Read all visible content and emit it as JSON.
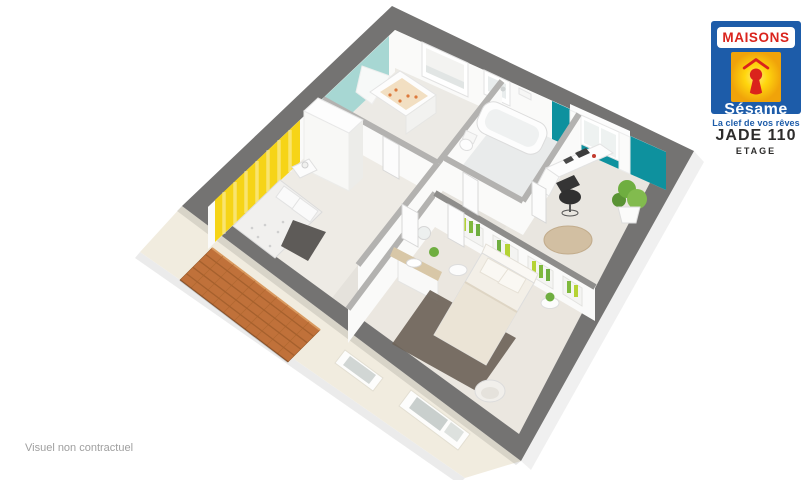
{
  "logo": {
    "brand_top": "MAISONS",
    "brand_script": "Sésame",
    "tagline": "La clef de vos rêves"
  },
  "plan": {
    "title": "JADE 110",
    "subtitle": "ETAGE",
    "disclaimer": "Visuel non contractuel"
  },
  "colors": {
    "logo_blue": "#1d5ca9",
    "logo_red": "#da231c",
    "logo_yellow": "#ffd60e",
    "logo_orange": "#f0a30a",
    "tagline_blue": "#1d5ca9",
    "title_dark": "#2d2c2b",
    "disclaimer_gray": "#9f9f9f",
    "outer_wall": "#747372",
    "wall_top": "#b3b2b0",
    "wall_top_dark": "#8e8d8b",
    "wall_face": "#fafaf9",
    "floor_base": "#e5e2dc",
    "floor_nursery": "#eceae5",
    "floor_bath": "#e9ebeb",
    "floor_office": "#e9e6e0",
    "floor_bed1": "#eeebe5",
    "floor_master": "#ebe7e0",
    "accent_aqua": "#a7d7d3",
    "accent_teal": "#0e919e",
    "accent_yellow": "#f6d417",
    "roof": "#c0713a",
    "roof_line": "#9a5a28",
    "facade": "#f1ecdf",
    "glass": "#c9cfcd",
    "rug_dark": "#6e6459",
    "rug_jute": "#d2bfa2",
    "throw_dark": "#5e5b58",
    "wood": "#d8c7a7",
    "plant": "#6fae40",
    "plant_light": "#b5d334",
    "chair_dark": "#303030",
    "bedding": "#f3efe7",
    "crib_bedding": "#f2dfc2",
    "crib_dot": "#dd7a3c"
  }
}
